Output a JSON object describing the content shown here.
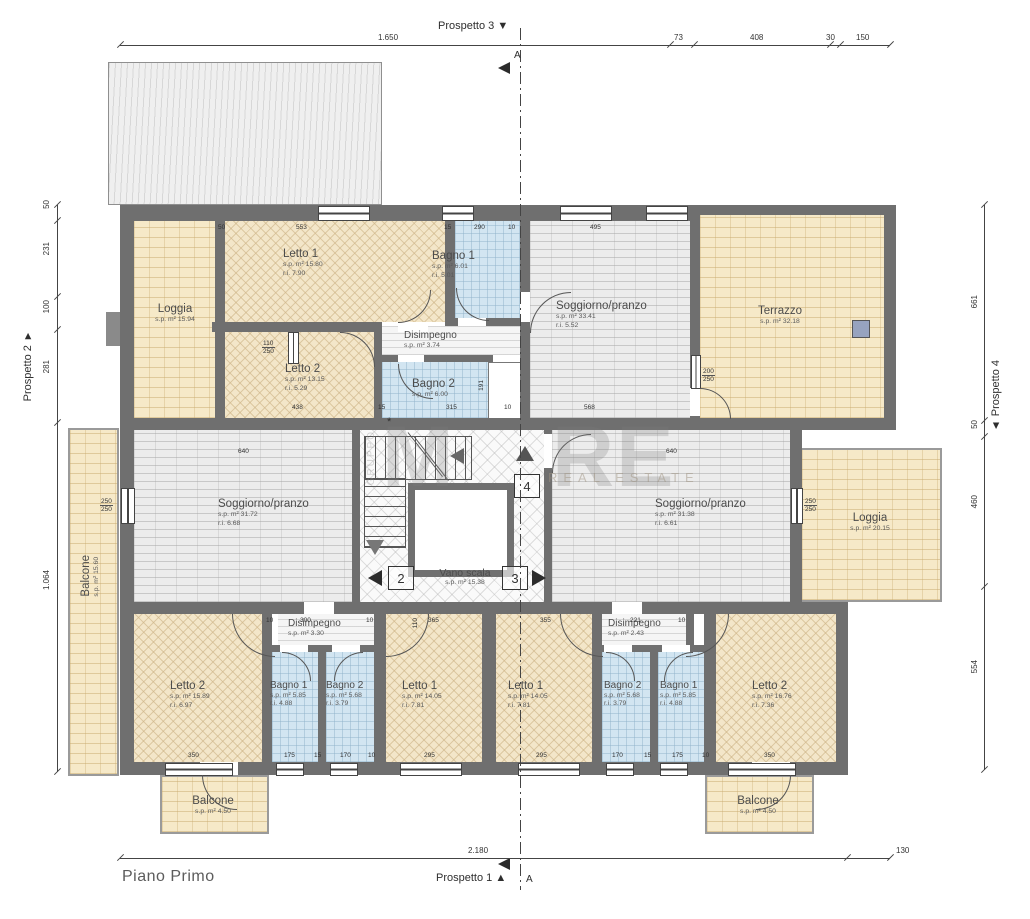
{
  "title": {
    "plan": "Piano Primo"
  },
  "prospetti": {
    "p1": "Prospetto 1 ▲",
    "p2": "Prospetto 2 ▼",
    "p3": "Prospetto 3 ▼",
    "p4": "▲ Prospetto 4",
    "section": "A"
  },
  "watermark": {
    "m1": "M",
    "m2": "RE",
    "sub": "REAL ESTATE",
    "side": "GRUPPO"
  },
  "dimensions": {
    "top": [
      "1.650",
      "73",
      "408",
      "30",
      "150"
    ],
    "bottom": [
      "2.180",
      "130"
    ],
    "left": [
      "50",
      "231",
      "100",
      "281",
      "1.064"
    ],
    "right": [
      "661",
      "50",
      "460",
      "554"
    ]
  },
  "rooms": {
    "letto1_nw": {
      "name": "Letto 1",
      "sp": "s.p. m² 15.80",
      "ri": "r.i. 7.90"
    },
    "bagno1_nw": {
      "name": "Bagno 1",
      "sp": "s.p. m² 6.01",
      "ri": "r.i. 5.01"
    },
    "soggiorno_n": {
      "name": "Soggiorno/pranzo",
      "sp": "s.p. m² 33.41",
      "ri": "r.i. 5.52"
    },
    "terrazzo": {
      "name": "Terrazzo",
      "sp": "s.p. m² 32.18",
      "ri": ""
    },
    "loggia_nw": {
      "name": "Loggia",
      "sp": "s.p. m² 15.94",
      "ri": ""
    },
    "letto2_nw": {
      "name": "Letto 2",
      "sp": "s.p. m² 13.15",
      "ri": "r.i. 5.29"
    },
    "disimpegno_n": {
      "name": "Disimpegno",
      "sp": "s.p. m² 3.74",
      "ri": ""
    },
    "bagno2_n": {
      "name": "Bagno 2",
      "sp": "s.p. m² 6.00",
      "ri": ""
    },
    "balcone_w": {
      "name": "Balcone",
      "sp": "s.p. m² 15.60",
      "ri": ""
    },
    "soggiorno_w": {
      "name": "Soggiorno/pranzo",
      "sp": "s.p. m² 31.72",
      "ri": "r.i. 6.68"
    },
    "vano_scala": {
      "name": "Vano scala",
      "sp": "s.p. m² 15.38",
      "ri": ""
    },
    "soggiorno_e": {
      "name": "Soggiorno/pranzo",
      "sp": "s.p. m² 31.38",
      "ri": "r.i. 6.61"
    },
    "loggia_e": {
      "name": "Loggia",
      "sp": "s.p. m² 20.15",
      "ri": ""
    },
    "disimpegno_sw": {
      "name": "Disimpegno",
      "sp": "s.p. m² 3.30",
      "ri": ""
    },
    "disimpegno_se": {
      "name": "Disimpegno",
      "sp": "s.p. m² 2.43",
      "ri": ""
    },
    "letto2_sw": {
      "name": "Letto 2",
      "sp": "s.p. m² 15.89",
      "ri": "r.i. 6.97"
    },
    "bagno1_sw": {
      "name": "Bagno 1",
      "sp": "s.p. m² 5.85",
      "ri": "r.i. 4.88"
    },
    "bagno2_sw": {
      "name": "Bagno 2",
      "sp": "s.p. m² 5.68",
      "ri": "r.i. 3.79"
    },
    "letto1_sw": {
      "name": "Letto 1",
      "sp": "s.p. m² 14.05",
      "ri": "r.i. 7.81"
    },
    "letto1_se": {
      "name": "Letto 1",
      "sp": "s.p. m² 14.05",
      "ri": "r.i. 7.81"
    },
    "bagno2_se": {
      "name": "Bagno 2",
      "sp": "s.p. m² 5.68",
      "ri": "r.i. 3.79"
    },
    "bagno1_se": {
      "name": "Bagno 1",
      "sp": "s.p. m² 5.85",
      "ri": "r.i. 4.88"
    },
    "letto2_se": {
      "name": "Letto 2",
      "sp": "s.p. m² 16.76",
      "ri": "r.i. 7.36"
    },
    "balcone_sw": {
      "name": "Balcone",
      "sp": "s.p. m² 4.50",
      "ri": ""
    },
    "balcone_se": {
      "name": "Balcone",
      "sp": "s.p. m² 4.50",
      "ri": ""
    }
  },
  "markers": {
    "m2": "2",
    "m3": "3",
    "m4": "4",
    "asterisk": "*"
  },
  "wall_dims": [
    "50",
    "553",
    "15",
    "290",
    "10",
    "495",
    "110",
    "250",
    "200",
    "250",
    "438",
    "15",
    "315",
    "10",
    "568",
    "640",
    "640",
    "250",
    "250",
    "250",
    "250",
    "300",
    "10",
    "10",
    "365",
    "355",
    "221",
    "10",
    "350",
    "175",
    "15",
    "170",
    "10",
    "295",
    "295",
    "170",
    "15",
    "175",
    "10",
    "350",
    "191",
    "110"
  ]
}
